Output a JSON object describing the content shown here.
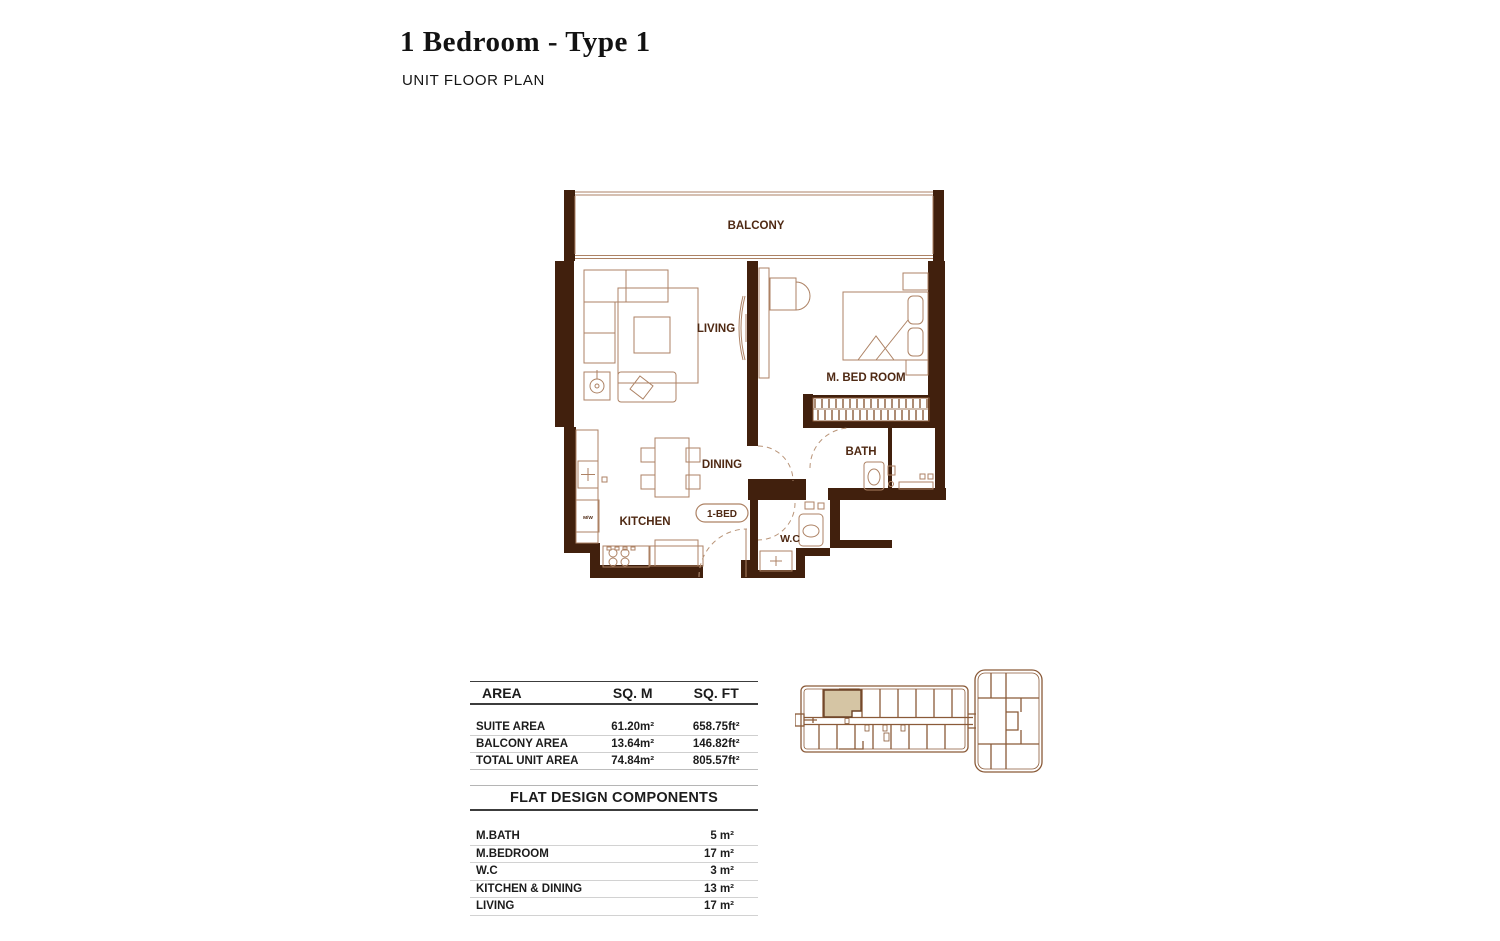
{
  "page": {
    "title": "1 Bedroom - Type 1",
    "subtitle": "UNIT FLOOR PLAN"
  },
  "floor_plan": {
    "labels": {
      "balcony": "BALCONY",
      "living": "LIVING",
      "m_bedroom": "M. BED ROOM",
      "dining": "DINING",
      "kitchen": "KITCHEN",
      "bath": "BATH",
      "wc": "W.C",
      "unit_tag": "1-BED",
      "microwave": "M/W"
    },
    "colors": {
      "wall": "#41200d",
      "furniture_line": "#ad8264",
      "label_text": "#4f2913"
    }
  },
  "area_table": {
    "headers": {
      "area": "AREA",
      "sqm": "SQ. M",
      "sqft": "SQ. FT"
    },
    "rows": [
      {
        "label": "SUITE AREA",
        "sqm": "61.20m²",
        "sqft": "658.75ft²"
      },
      {
        "label": "BALCONY AREA",
        "sqm": "13.64m²",
        "sqft": "146.82ft²"
      },
      {
        "label": "TOTAL UNIT AREA",
        "sqm": "74.84m²",
        "sqft": "805.57ft²"
      }
    ]
  },
  "components_table": {
    "title": "FLAT DESIGN COMPONENTS",
    "rows": [
      {
        "label": "M.BATH",
        "value": "5 m²"
      },
      {
        "label": "M.BEDROOM",
        "value": "17 m²"
      },
      {
        "label": "W.C",
        "value": "3 m²"
      },
      {
        "label": "KITCHEN & DINING",
        "value": "13 m²"
      },
      {
        "label": "LIVING",
        "value": "17 m²"
      }
    ]
  },
  "key_plan": {
    "outline_color": "#8a5a38",
    "highlight_color": "#d5c5a4"
  }
}
